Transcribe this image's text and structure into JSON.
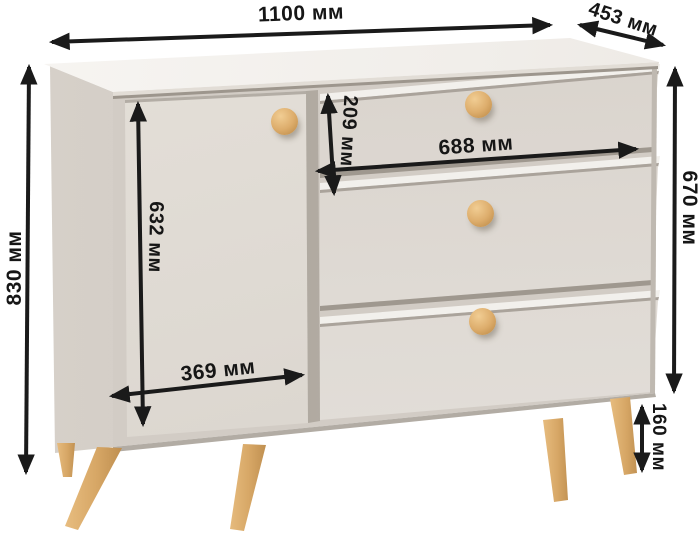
{
  "diagram": {
    "type": "furniture-dimension-diagram",
    "product": "chest of drawers with one door and three drawers on wooden legs",
    "unit": "мм",
    "colors": {
      "arrow": "#1a1a1a",
      "body": "#ded8d1",
      "top": "#f4f2ee",
      "wood": "#d9a96b",
      "background": "#ffffff"
    },
    "dims": {
      "width": {
        "value": 1100,
        "label": "1100 мм"
      },
      "depth": {
        "value": 453,
        "label": "453 мм"
      },
      "height": {
        "value": 830,
        "label": "830 мм"
      },
      "body_height": {
        "value": 670,
        "label": "670 мм"
      },
      "door_height": {
        "value": 632,
        "label": "632 мм"
      },
      "drawer_height": {
        "value": 209,
        "label": "209 мм"
      },
      "drawer_width": {
        "value": 688,
        "label": "688 мм"
      },
      "door_width": {
        "value": 369,
        "label": "369 мм"
      },
      "leg_height": {
        "value": 160,
        "label": "160 мм"
      }
    }
  }
}
